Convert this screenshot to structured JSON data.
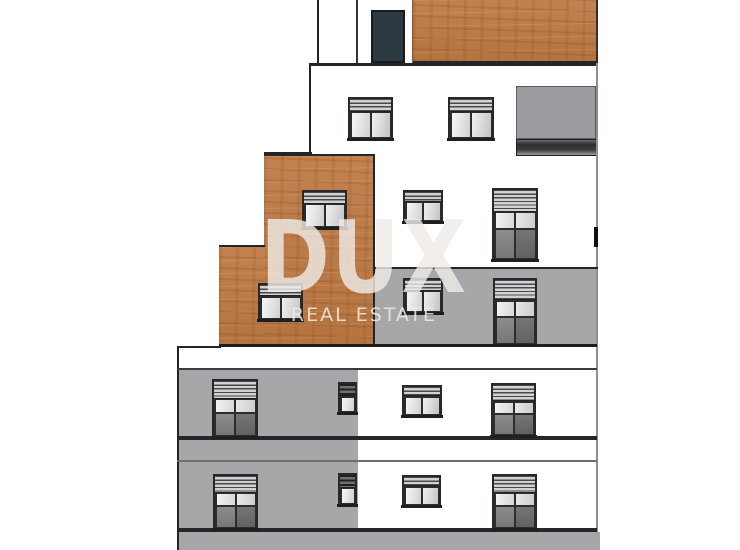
{
  "watermark": {
    "title": "DUX",
    "subtitle": "REAL ESTATE"
  },
  "palette": {
    "background": "#ffffff",
    "wood": "#bc7b45",
    "facade_gray": "#a7a7aa",
    "loggia_gray": "#9b9c9f",
    "door": "#2c3940",
    "line_dark": "#222427",
    "edge_gray": "#8f8f93"
  },
  "building": {
    "description": "stepped-residential-building-elevation",
    "door": {
      "name": "rooftop-door",
      "x": 371,
      "y": 10,
      "w": 34,
      "h": 53
    },
    "blocks": [
      {
        "name": "ground-strip",
        "cls": "gray",
        "x": 177,
        "y": 532,
        "w": 423,
        "h": 18
      },
      {
        "name": "facade-gray-left-column",
        "cls": "gray",
        "x": 177,
        "y": 369,
        "w": 181,
        "h": 181
      },
      {
        "name": "facade-gray-mid-right",
        "cls": "gray",
        "x": 375,
        "y": 269,
        "w": 221,
        "h": 77
      },
      {
        "name": "facade-wood-top",
        "cls": "wood wood-top",
        "x": 412,
        "y": 0,
        "w": 186,
        "h": 64
      },
      {
        "name": "facade-wood-upper",
        "cls": "wood wood-upper",
        "x": 264,
        "y": 154,
        "w": 111,
        "h": 192
      },
      {
        "name": "facade-wood-lower",
        "cls": "wood wood-lower",
        "x": 219,
        "y": 245,
        "w": 46,
        "h": 101
      },
      {
        "name": "loggia-recess",
        "cls": "loggia",
        "x": 516,
        "y": 86,
        "w": 80,
        "h": 53
      },
      {
        "name": "loggia-shadow-band",
        "cls": "loggia-band",
        "x": 516,
        "y": 139,
        "w": 82,
        "h": 17
      }
    ],
    "lines": [
      {
        "name": "roof-left-edge",
        "x": 317,
        "y": 0,
        "w": 2,
        "h": 64,
        "color": "#222427"
      },
      {
        "name": "roof-divider",
        "x": 356,
        "y": 0,
        "w": 2,
        "h": 64,
        "color": "#34373b"
      },
      {
        "name": "upper-left-edge",
        "x": 309,
        "y": 63,
        "w": 2,
        "h": 92,
        "color": "#222427"
      },
      {
        "name": "floor-line-top",
        "x": 309,
        "y": 63,
        "w": 289,
        "h": 3,
        "color": "#222427"
      },
      {
        "name": "ledge-line",
        "x": 264,
        "y": 152,
        "w": 48,
        "h": 2,
        "color": "#222427"
      },
      {
        "name": "right-edge",
        "x": 596,
        "y": 63,
        "w": 2,
        "h": 470,
        "color": "#8f8f93"
      },
      {
        "name": "right-edge-mark",
        "x": 594,
        "y": 227,
        "w": 4,
        "h": 20,
        "color": "#101114"
      },
      {
        "name": "gray-top-line",
        "x": 375,
        "y": 267,
        "w": 223,
        "h": 2,
        "color": "#222427"
      },
      {
        "name": "slab-line-1",
        "x": 219,
        "y": 344,
        "w": 378,
        "h": 3,
        "color": "#1c1e20"
      },
      {
        "name": "step-line",
        "x": 177,
        "y": 346,
        "w": 44,
        "h": 2,
        "color": "#222427"
      },
      {
        "name": "lower-left-edge",
        "x": 177,
        "y": 346,
        "w": 2,
        "h": 204,
        "color": "#222427"
      },
      {
        "name": "floor-line-2",
        "x": 177,
        "y": 368,
        "w": 420,
        "h": 2,
        "color": "#3a3c3f"
      },
      {
        "name": "sill-band-1",
        "x": 177,
        "y": 436,
        "w": 420,
        "h": 4,
        "color": "#242629"
      },
      {
        "name": "slab-thin-line",
        "x": 177,
        "y": 460,
        "w": 420,
        "h": 2,
        "color": "#6e6e71"
      },
      {
        "name": "sill-band-2",
        "x": 177,
        "y": 528,
        "w": 420,
        "h": 4,
        "color": "#242629"
      }
    ],
    "windows": [
      {
        "type": "std",
        "x": 348,
        "y": 97,
        "w": 45,
        "h": 43
      },
      {
        "type": "std",
        "x": 448,
        "y": 97,
        "w": 46,
        "h": 43
      },
      {
        "type": "std",
        "x": 302,
        "y": 190,
        "w": 45,
        "h": 39
      },
      {
        "type": "std",
        "x": 403,
        "y": 190,
        "w": 40,
        "h": 33
      },
      {
        "type": "tall",
        "x": 492,
        "y": 188,
        "w": 46,
        "h": 73
      },
      {
        "type": "std",
        "x": 258,
        "y": 283,
        "w": 45,
        "h": 38
      },
      {
        "type": "std",
        "x": 403,
        "y": 278,
        "w": 40,
        "h": 36
      },
      {
        "type": "tall",
        "x": 493,
        "y": 278,
        "w": 44,
        "h": 68
      },
      {
        "type": "tall",
        "x": 212,
        "y": 379,
        "w": 46,
        "h": 59
      },
      {
        "type": "narrow",
        "x": 338,
        "y": 382,
        "w": 19,
        "h": 32
      },
      {
        "type": "std",
        "x": 402,
        "y": 385,
        "w": 40,
        "h": 32
      },
      {
        "type": "tall",
        "x": 491,
        "y": 383,
        "w": 45,
        "h": 54
      },
      {
        "type": "tall",
        "x": 213,
        "y": 474,
        "w": 45,
        "h": 56
      },
      {
        "type": "narrow",
        "x": 338,
        "y": 473,
        "w": 19,
        "h": 33
      },
      {
        "type": "std",
        "x": 402,
        "y": 475,
        "w": 39,
        "h": 32
      },
      {
        "type": "tall",
        "x": 492,
        "y": 474,
        "w": 45,
        "h": 56
      }
    ]
  }
}
